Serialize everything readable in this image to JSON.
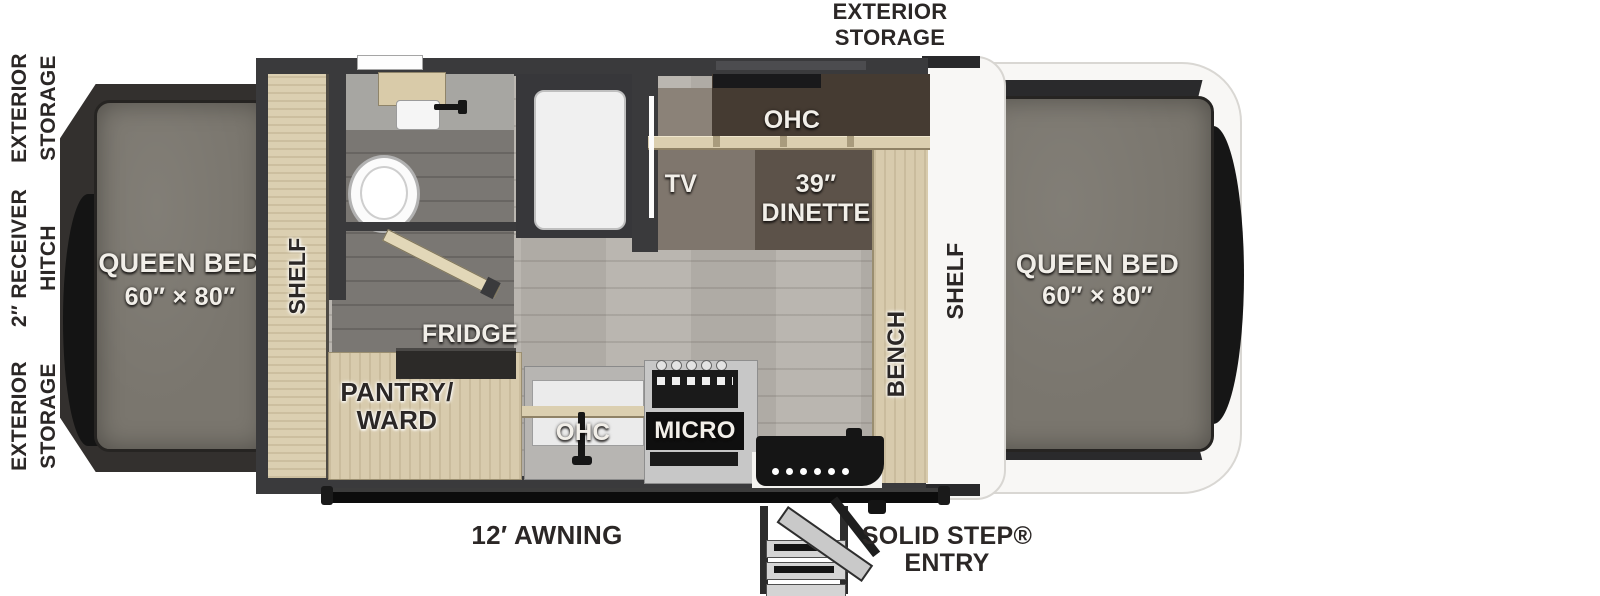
{
  "diagram": {
    "type": "travel-trailer-floorplan",
    "colors": {
      "wall": "#3a3a3c",
      "floor_light": "#b6b2ac",
      "floor_dark": "#7a7773",
      "mattress": "#7a766e",
      "cabinet_tan": "#d9cdae",
      "accent_black": "#151515",
      "end_cap_white": "#f8f7f5",
      "label_light": "#f2efe9",
      "label_dark": "#2b2726"
    },
    "exterior": {
      "storage_top": "EXTERIOR STORAGE",
      "storage_front": "EXTERIOR STORAGE",
      "hitch": "2″ RECEIVER HITCH",
      "storage_rear": "EXTERIOR STORAGE",
      "awning": "12′ AWNING",
      "entry": "SOLID STEP® ENTRY"
    },
    "rooms": {
      "bed_front": {
        "name": "QUEEN BED",
        "size": "60″ × 80″"
      },
      "bed_rear": {
        "name": "QUEEN BED",
        "size": "60″ × 80″"
      },
      "dinette": {
        "size": "39″",
        "name": "DINETTE"
      },
      "shelf_front": "SHELF",
      "shelf_rear": "SHELF",
      "bench": "BENCH",
      "tv": "TV",
      "ohc_dinette": "OHC",
      "ohc_kitchen": "OHC",
      "micro": "MICRO",
      "fridge": "FRIDGE",
      "pantry": "PANTRY/ WARD"
    }
  }
}
